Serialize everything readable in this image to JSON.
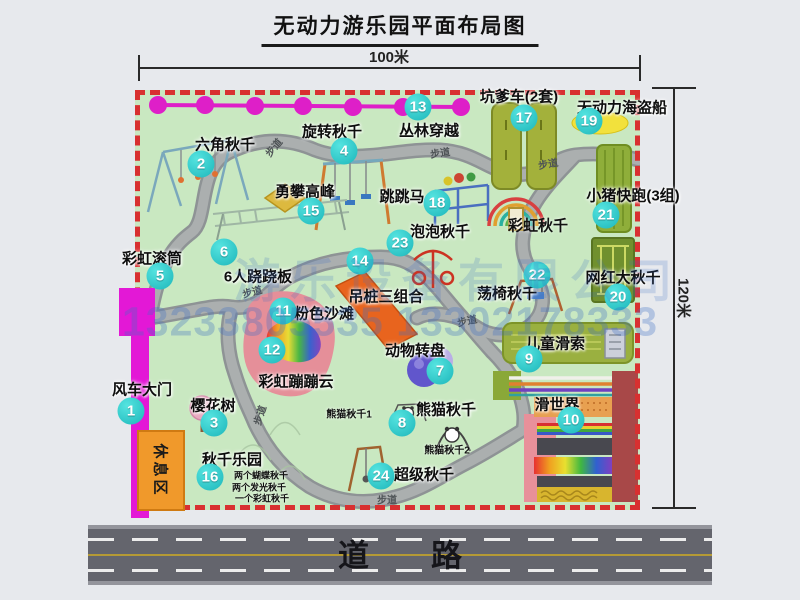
{
  "title": "无动力游乐园平面布局图",
  "dimensions": {
    "width_label": "100米",
    "height_label": "120米"
  },
  "road": {
    "label": "道路"
  },
  "rest_area": {
    "label": "休息区"
  },
  "watermark": {
    "company": "游乐设备有限公司",
    "phone": "13233805535 13302178333"
  },
  "colors": {
    "park_green": "#c9e8c1",
    "border_red": "#d83030",
    "badge_teal": "#2ed0cf",
    "gate_magenta": "#e318d6",
    "zipline_magenta": "#de1fc8",
    "rest_orange": "#f0992b",
    "road_gray": "#64656d",
    "watermark_blue": "#3c6ec4"
  },
  "attractions": [
    {
      "id": 1,
      "name": "风车大门",
      "badge": [
        131,
        411
      ],
      "label": [
        142,
        389
      ]
    },
    {
      "id": 2,
      "name": "六角秋千",
      "badge": [
        201,
        164
      ],
      "label": [
        225,
        144
      ]
    },
    {
      "id": 3,
      "name": "樱花树",
      "badge": [
        214,
        423
      ],
      "label": [
        213,
        405
      ]
    },
    {
      "id": 4,
      "name": "旋转秋千",
      "badge": [
        344,
        151
      ],
      "label": [
        332,
        131
      ]
    },
    {
      "id": 5,
      "name": "彩虹滚筒",
      "badge": [
        160,
        276
      ],
      "label": [
        152,
        258
      ]
    },
    {
      "id": 6,
      "name": "6人跷跷板",
      "badge": [
        224,
        252
      ],
      "label": [
        258,
        276
      ]
    },
    {
      "id": 7,
      "name": "动物转盘",
      "badge": [
        440,
        371
      ],
      "label": [
        415,
        350
      ]
    },
    {
      "id": 8,
      "name": "熊猫秋千",
      "badge": [
        402,
        423
      ],
      "label": [
        446,
        409
      ]
    },
    {
      "id": 9,
      "name": "儿童滑索",
      "badge": [
        529,
        359
      ],
      "label": [
        555,
        343
      ]
    },
    {
      "id": 10,
      "name": "滑世界",
      "badge": [
        571,
        420
      ],
      "label": [
        557,
        404
      ]
    },
    {
      "id": 11,
      "name": "粉色沙滩",
      "badge": [
        283,
        311
      ],
      "label": [
        324,
        313
      ]
    },
    {
      "id": 12,
      "name": "彩虹蹦蹦云",
      "badge": [
        272,
        350
      ],
      "label": [
        296,
        381
      ]
    },
    {
      "id": 13,
      "name": "丛林穿越",
      "badge": [
        418,
        107
      ],
      "label": [
        429,
        130
      ]
    },
    {
      "id": 14,
      "name": "吊桩三组合",
      "badge": [
        360,
        261
      ],
      "label": [
        386,
        296
      ]
    },
    {
      "id": 15,
      "name": "勇攀高峰",
      "badge": [
        311,
        211
      ],
      "label": [
        305,
        191
      ]
    },
    {
      "id": 16,
      "name": "秋千乐园",
      "badge": [
        210,
        477
      ],
      "label": [
        232,
        459
      ]
    },
    {
      "id": 17,
      "name": "坑爹车(2套)",
      "badge": [
        524,
        118
      ],
      "label": [
        519,
        96
      ]
    },
    {
      "id": 18,
      "name": "跳跳马",
      "badge": [
        437,
        203
      ],
      "label": [
        402,
        196
      ]
    },
    {
      "id": 19,
      "name": "无动力海盗船",
      "badge": [
        589,
        121
      ],
      "label": [
        622,
        107
      ]
    },
    {
      "id": 20,
      "name": "网红大秋千",
      "badge": [
        618,
        297
      ],
      "label": [
        623,
        277
      ]
    },
    {
      "id": 21,
      "name": "小猪快跑(3组)",
      "badge": [
        606,
        215
      ],
      "label": [
        633,
        195
      ]
    },
    {
      "id": 22,
      "name": "荡椅秋千",
      "badge": [
        537,
        275
      ],
      "label": [
        507,
        293
      ]
    },
    {
      "id": 23,
      "name": "泡泡秋千",
      "badge": [
        400,
        243
      ],
      "label": [
        440,
        231
      ]
    },
    {
      "id": 24,
      "name": "超级秋千",
      "badge": [
        381,
        476
      ],
      "label": [
        424,
        474
      ]
    }
  ],
  "extra_labels": [
    {
      "text": "彩虹秋千",
      "x": 538,
      "y": 225,
      "size": 15
    },
    {
      "text": "熊猫秋千1",
      "x": 349,
      "y": 413,
      "size": 10
    },
    {
      "text": "熊猫秋千2",
      "x": 447,
      "y": 449,
      "size": 10
    },
    {
      "text": "两个蝴蝶秋千",
      "x": 261,
      "y": 475,
      "size": 9
    },
    {
      "text": "两个发光秋千",
      "x": 259,
      "y": 487,
      "size": 9
    },
    {
      "text": "一个彩虹秋千",
      "x": 262,
      "y": 498,
      "size": 9
    }
  ],
  "path_labels": [
    {
      "text": "步道",
      "x": 273,
      "y": 147,
      "rot": -50
    },
    {
      "text": "步道",
      "x": 440,
      "y": 152,
      "rot": -8
    },
    {
      "text": "步道",
      "x": 548,
      "y": 163,
      "rot": -10
    },
    {
      "text": "步道",
      "x": 252,
      "y": 291,
      "rot": -15
    },
    {
      "text": "步道",
      "x": 467,
      "y": 320,
      "rot": -12
    },
    {
      "text": "步道",
      "x": 259,
      "y": 415,
      "rot": -72
    },
    {
      "text": "步道",
      "x": 387,
      "y": 499,
      "rot": 0
    }
  ]
}
